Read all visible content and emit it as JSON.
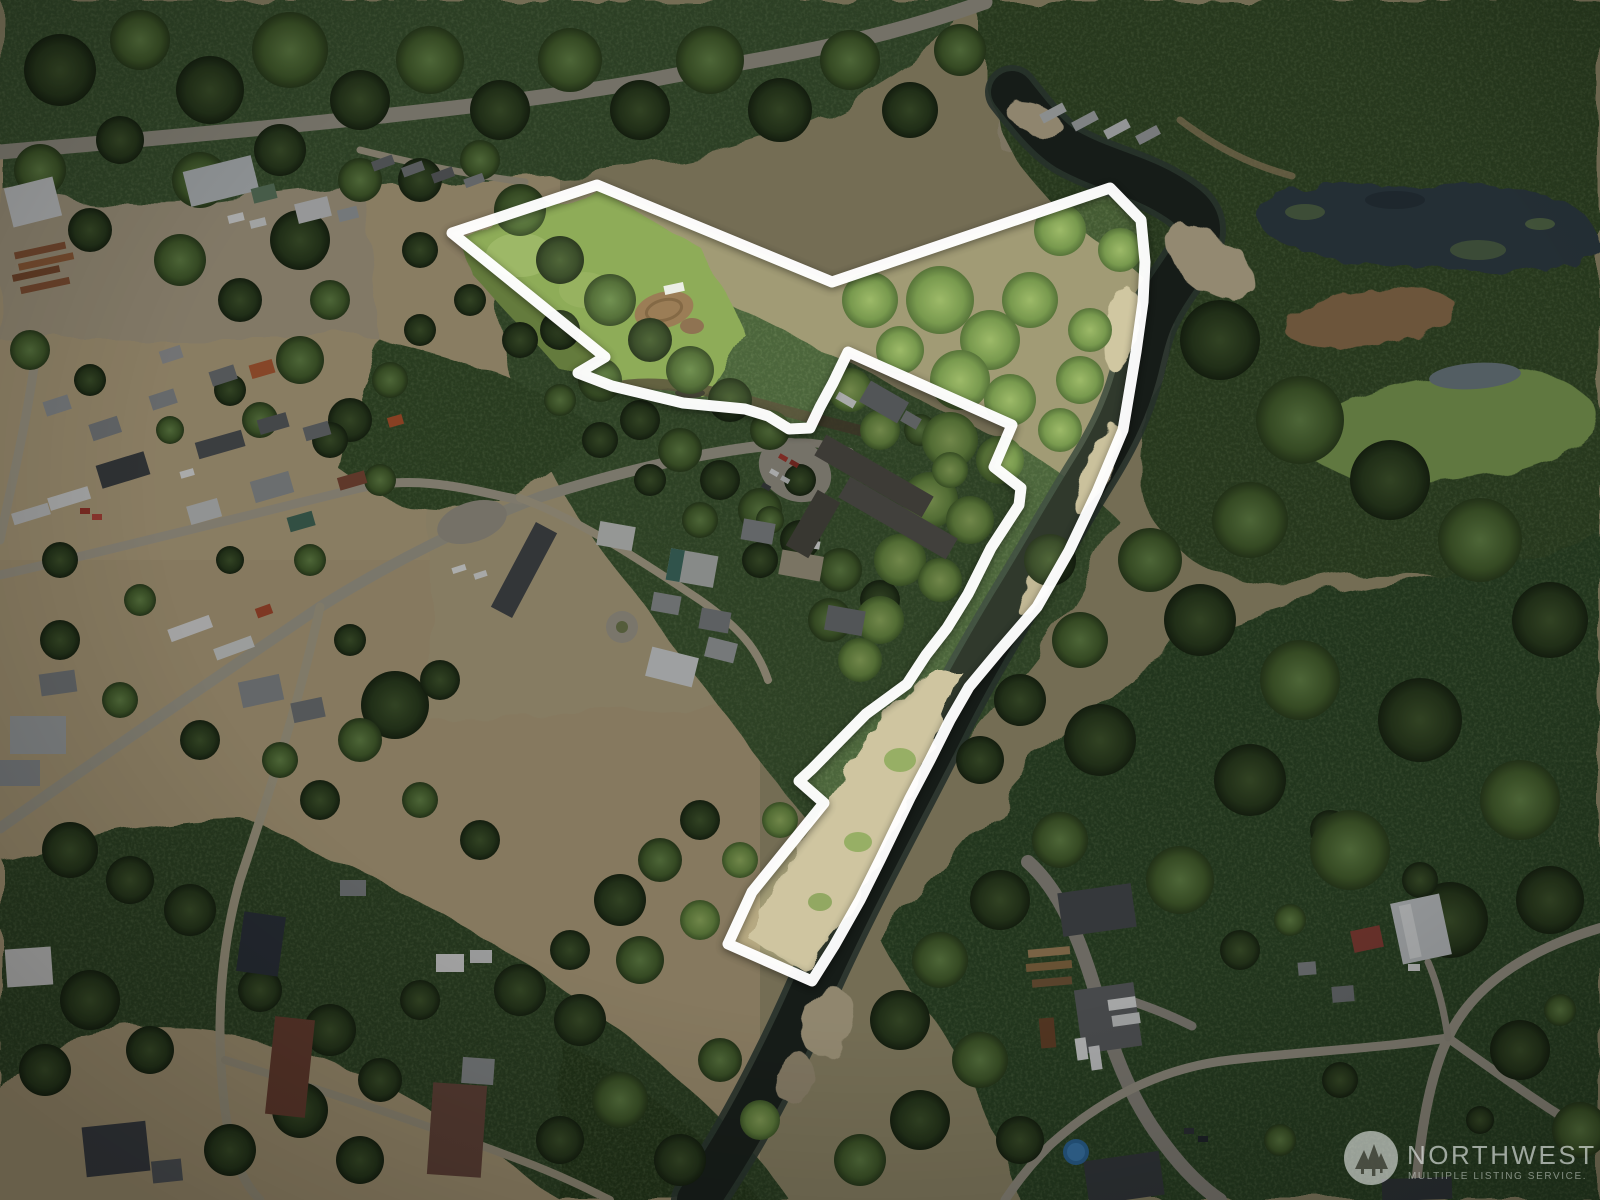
{
  "watermark": {
    "logo_icon": "nwmls-trees-logo-icon",
    "title": "NORTHWEST",
    "subtitle": "MULTIPLE LISTING SERVICE."
  },
  "property_outline": {
    "color": "#ffffff",
    "stroke_width": 11,
    "points": "597,185 832,282 1110,188 1141,220 1145,262 1143,302 1136,352 1123,430 1097,492 1069,551 1037,607 999,651 969,687 950,720 930,760 910,798 880,860 860,900 834,946 812,981 728,944 752,892 824,803 799,781 812,769 866,714 907,684 926,655 947,628 968,594 991,548 1019,505 1021,488 994,467 1012,425 848,352 833,383 820,407 810,428 789,429 768,416 745,409 683,403 612,386 578,373 605,357 452,233"
  },
  "palette": {
    "forest_dark": "#24381d",
    "forest_mid": "#3a5531",
    "forest_light": "#6f9150",
    "meadow_bright": "#85a451",
    "dry_grass": "#b7a684",
    "gravel": "#c6b998",
    "road": "#a39e90",
    "asphalt": "#8f8c83",
    "river_water": "#1c2420",
    "pond_water": "#2e3d46",
    "marsh_green": "#7fa055",
    "dim_overlay": "rgba(6,8,5,0.26)",
    "outline_white": "#ffffff"
  }
}
